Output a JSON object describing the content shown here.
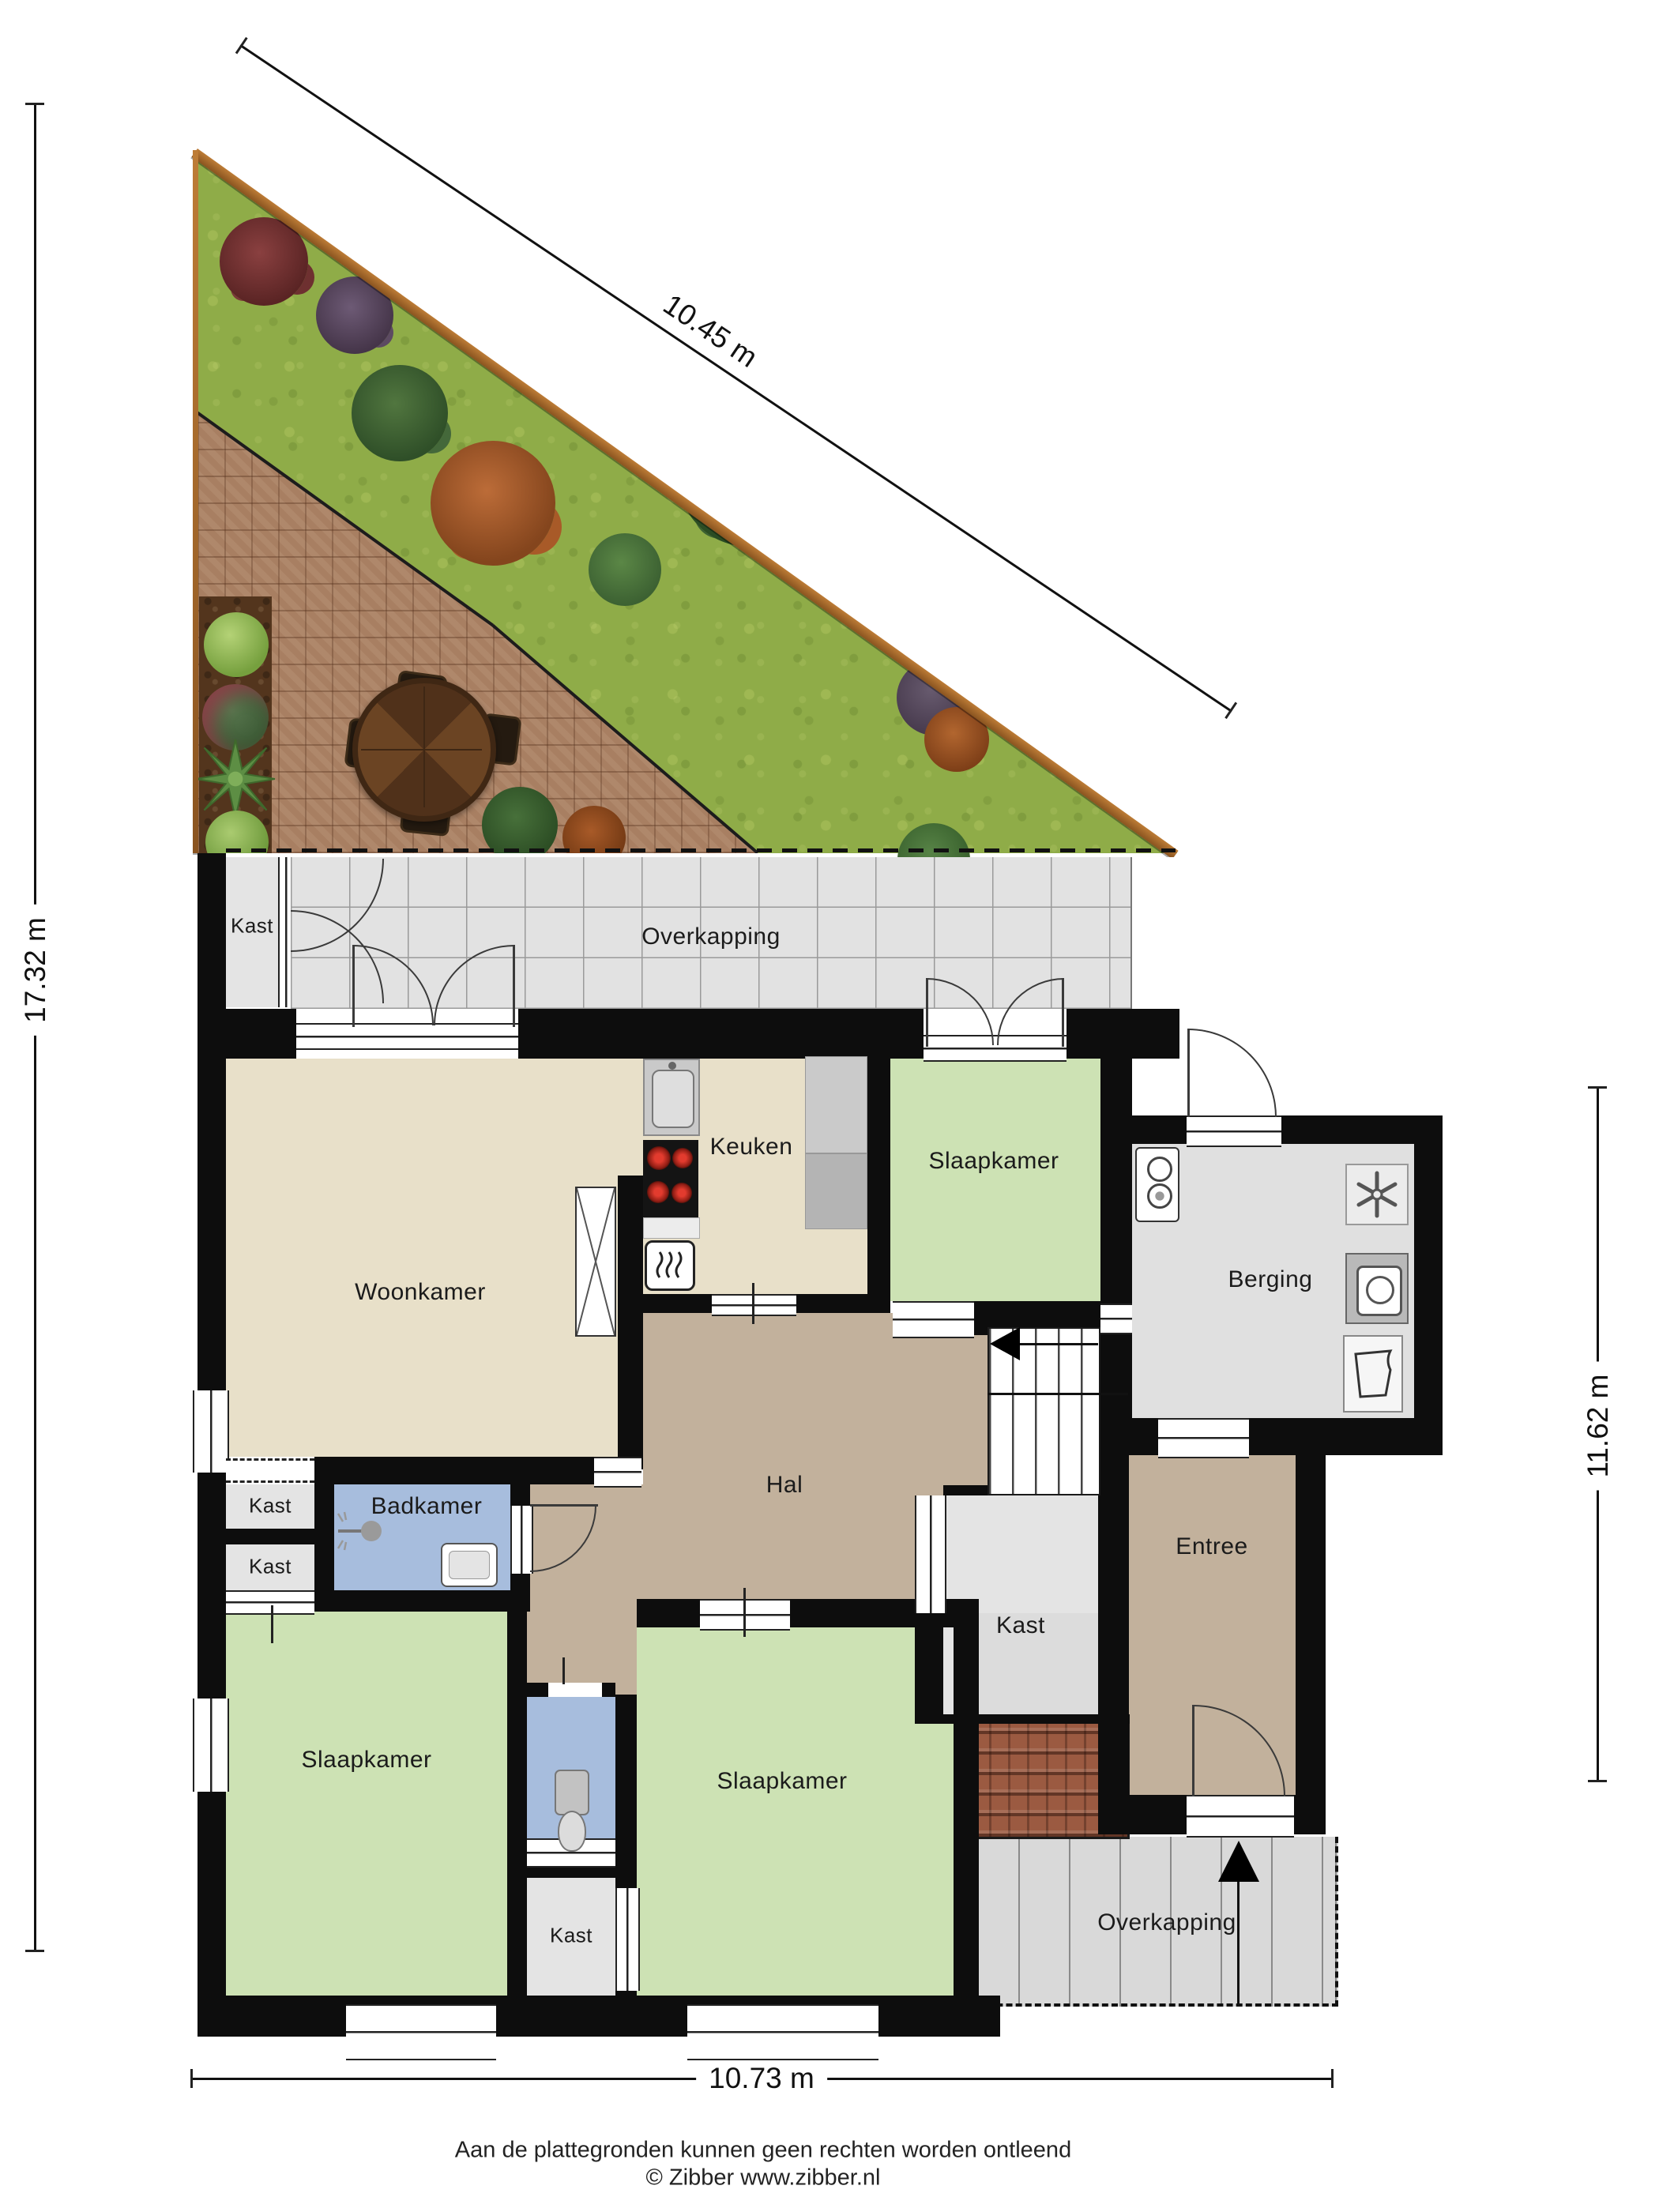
{
  "plan_type": "floorplan",
  "dimensions": {
    "top_diagonal": "10.45 m",
    "left": "17.32 m",
    "right": "11.62 m",
    "bottom": "10.73 m"
  },
  "rooms": {
    "kast_top": {
      "label": "Kast"
    },
    "overkapping_top": {
      "label": "Overkapping"
    },
    "woonkamer": {
      "label": "Woonkamer"
    },
    "keuken": {
      "label": "Keuken"
    },
    "slaapkamer_rechtsboven": {
      "label": "Slaapkamer"
    },
    "berging": {
      "label": "Berging"
    },
    "hal": {
      "label": "Hal"
    },
    "badkamer": {
      "label": "Badkamer"
    },
    "kast_links_1": {
      "label": "Kast"
    },
    "kast_links_2": {
      "label": "Kast"
    },
    "slaapkamer_linksonder": {
      "label": "Slaapkamer"
    },
    "slaapkamer_midden": {
      "label": "Slaapkamer"
    },
    "kast_trap": {
      "label": "Kast"
    },
    "kast_onder": {
      "label": "Kast"
    },
    "entree": {
      "label": "Entree"
    },
    "overkapping_onder": {
      "label": "Overkapping"
    }
  },
  "footer": {
    "line1": "Aan de plattegronden kunnen geen rechten worden ontleend",
    "line2": "© Zibber www.zibber.nl"
  },
  "colors": {
    "wall": "#0d0d0d",
    "beige": "#e8e0c9",
    "green": "#cde2b4",
    "blue": "#a7bddd",
    "tan": "#c2b19c",
    "gray": "#e4e4e4",
    "tile": "#e2e2e2",
    "overkapping": "#d9d9d9",
    "grass": "#8fac48",
    "brick": "#a87f62",
    "soil": "#53351d",
    "fence": "#9c6431",
    "rooftile": "#9b5a41",
    "stove_burner": "#cc2222"
  }
}
